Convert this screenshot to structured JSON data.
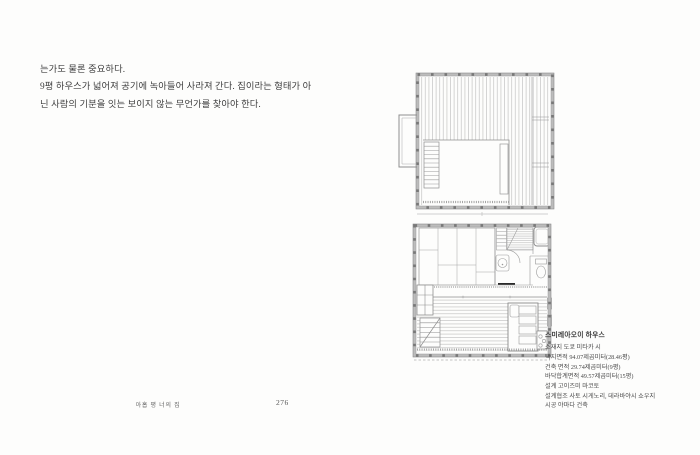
{
  "page": {
    "paragraph": {
      "lines": [
        "는가도 물론 중요하다.",
        "9평 하우스가 넓어져 공기에 녹아들어 사라져 간다. 집이라는 형태가 아",
        "닌 사람의 기분을 잇는 보이지 않는 무언가를 찾아야 한다."
      ]
    },
    "caption": {
      "title": "스미레아오이 하우스",
      "lines": [
        "소재지 도쿄 미타카 시",
        "택지면적 94.07제곱미터(28.46평)",
        "건축 면적 29.74제곱미터(9평)",
        "바닥합계면적 49.57제곱미터(15평)",
        "설계 고이즈미 마코토",
        "설계협조 사토 시게노리, 데라바야시 쇼우지",
        "시공 야마다 건축"
      ]
    },
    "footer": {
      "book_title": "아홉 평 너의 집",
      "page_number": "276"
    },
    "colors": {
      "page_bg": "#fdfdfc",
      "body_text": "#3f3f3f",
      "caption_text": "#4c4c4c",
      "plan_line_light": "#b4b4b4",
      "plan_line": "#9a9a9a",
      "plan_border": "#8a8a8a",
      "plan_tick": "#787878",
      "threshold_bar": "#2a2a2a"
    }
  }
}
